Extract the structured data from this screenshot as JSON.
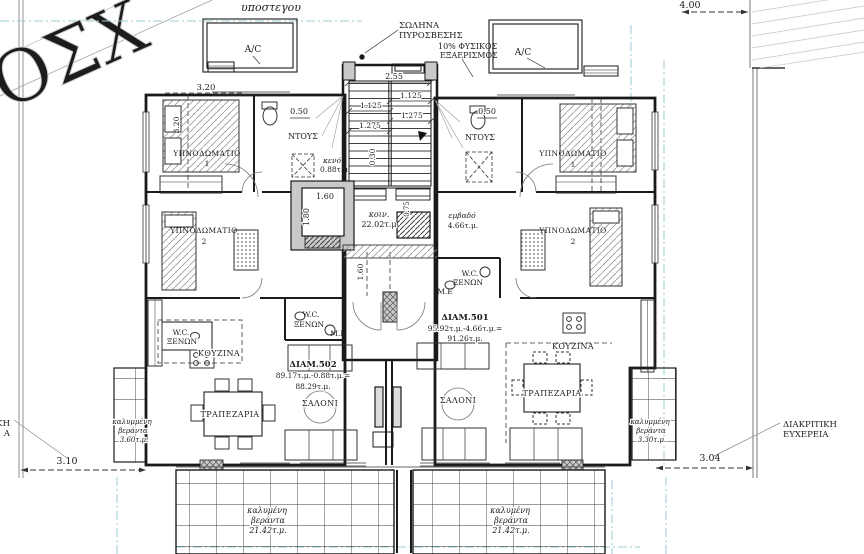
{
  "site": {
    "top_label": "υποστεγου",
    "watermark": "ΟΣΧ",
    "dim_top_right": "4.00",
    "dim_bottom_left": "3.10",
    "dim_bottom_right": "3.04",
    "right_note_line1": "ΔΙΑΚΡΙΤΙΚΗ",
    "right_note_line2": "ΕΥΧΕΡΕΙΑ",
    "left_note_line1": "ΚΗ",
    "left_note_line2": "Α"
  },
  "notes": {
    "fire_line1": "ΣΩΛΗΝΑ",
    "fire_line2": "ΠΥΡΟΣΒΕΣΗΣ",
    "vent_line1": "10% ΦΥΣΙΚΟΣ",
    "vent_line2": "ΕΞΑΕΡΙΣΜΟΣ",
    "ac": "A/C"
  },
  "core": {
    "common_label": "κοιν.",
    "common_area": "22.02τ.μ",
    "shaft_label": "εμβαδό",
    "shaft_area": "4.66τ.μ.",
    "void_label": "κενό",
    "void_area": "0.88τ.μ",
    "dims": {
      "w": "2.55",
      "t1": "1.125",
      "t2": "1.125",
      "t3": "1.275",
      "t4": "1.275",
      "r": "0.30",
      "lift_w": "1.60",
      "lift_d": "1.80",
      "duct": "0.75",
      "entry": "1.60"
    }
  },
  "apartments": {
    "a501": {
      "name": "ΔΙΑΜ.501",
      "calc": "95.92τ.μ.-4.66τ.μ.=",
      "total": "91.26τ.μ."
    },
    "a502": {
      "name": "ΔΙΑΜ.502",
      "calc": "89.17τ.μ.-0.88τ.μ.=",
      "total": "88.29τ.μ."
    }
  },
  "rooms": {
    "bedroom": "ΥΠΝΟΔΩΜΑΤΙΟ",
    "one": "1",
    "two": "2",
    "shower": "ΝΤΟΥΣ",
    "wc": "W.C.",
    "guests": "ΞΕΝΩΝ",
    "me": "Μ.Ε",
    "kitchen": "ΚΟΥΖΙΝΑ",
    "dining": "ΤΡΑΠΕΖΑΡΙΑ",
    "living": "ΣΑΛΟΝΙ"
  },
  "verandas": {
    "covered1": "καλυμμένη",
    "covered2": "βεράντα",
    "left_area": "3.60τ.μ.",
    "right_area": "3.30τ.μ.",
    "big1": "καλυμένη",
    "big2": "βεράντα",
    "big_area": "21.42τ.μ."
  },
  "dims": {
    "d320": "3.20",
    "d050": "0.50"
  }
}
